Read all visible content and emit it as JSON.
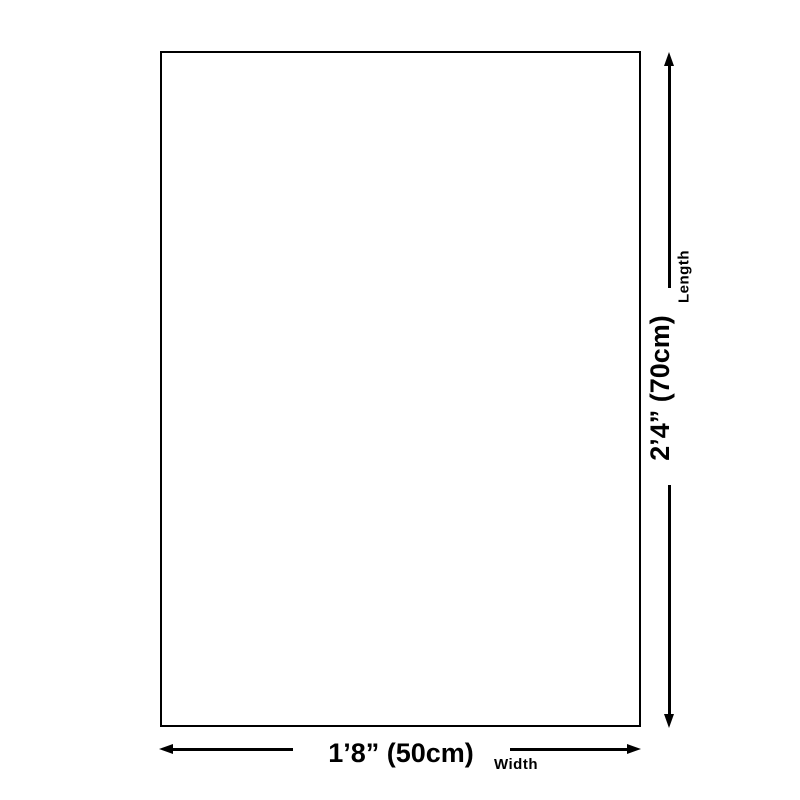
{
  "colors": {
    "line": "#000000",
    "background": "#ffffff"
  },
  "diagram": {
    "length": {
      "value": "2’4” (70cm)",
      "label": "Length"
    },
    "width": {
      "value": "1’8” (50cm)",
      "label": "Width"
    }
  }
}
